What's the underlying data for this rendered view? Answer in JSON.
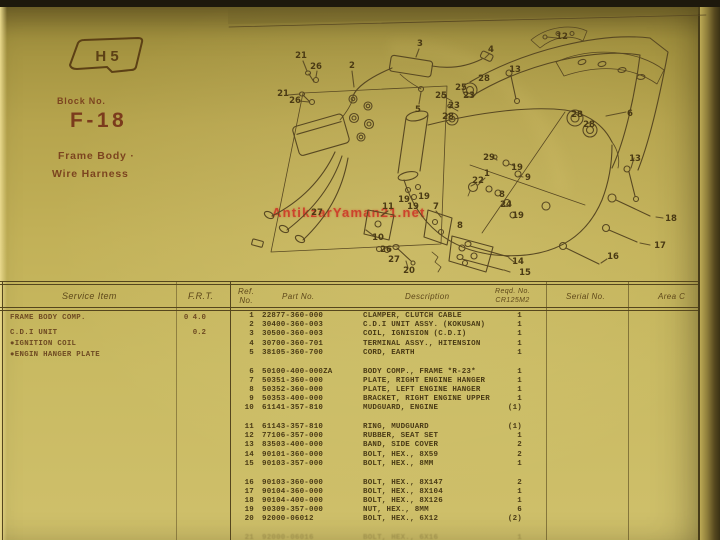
{
  "colors": {
    "page_bg": "#c2b158",
    "ink": "#493a15",
    "header_red": "#7b3b1c",
    "watermark_red": "#cd3425"
  },
  "header": {
    "badge": "H 5",
    "block_label": "Block No.",
    "block_no": "F-18",
    "subtitle1": "Frame Body ·",
    "subtitle2": "Wire Harness",
    "watermark": "AntikzarYaman21.net"
  },
  "service_table": {
    "headers": {
      "item": "Service Item",
      "frt": "F.R.T."
    },
    "rows": [
      {
        "item": "FRAME BODY COMP.",
        "frt": "0 4.0"
      },
      {
        "item": "C.D.I UNIT",
        "frt": "0.2"
      },
      {
        "item": "●IGNITION COIL",
        "frt": ""
      },
      {
        "item": "●ENGIN HANGER PLATE",
        "frt": ""
      }
    ]
  },
  "parts_table": {
    "headers": {
      "ref_line1": "Ref.",
      "ref_line2": "No.",
      "part": "Part No.",
      "desc": "Description",
      "reqd_line1": "Reqd. No.",
      "reqd_line2": "CR125M2",
      "serial": "Serial No.",
      "area": "Area C"
    },
    "rows": [
      {
        "ref": "1",
        "part": "22877-360-000",
        "desc": "CLAMPER, CLUTCH CABLE",
        "qty": "1"
      },
      {
        "ref": "2",
        "part": "30400-360-003",
        "desc": "C.D.I UNIT ASSY. (KOKUSAN)",
        "qty": "1"
      },
      {
        "ref": "3",
        "part": "30500-360-003",
        "desc": "COIL, IGNISION (C.D.I)",
        "qty": "1"
      },
      {
        "ref": "4",
        "part": "30700-360-701",
        "desc": "TERMINAL ASSY., HITENSION",
        "qty": "1"
      },
      {
        "ref": "5",
        "part": "38105-360-700",
        "desc": "CORD, EARTH",
        "qty": "1"
      },
      {
        "ref": "6",
        "part": "50100-400-000ZA",
        "desc": "BODY COMP., FRAME *R-23*",
        "qty": "1"
      },
      {
        "ref": "7",
        "part": "50351-360-000",
        "desc": "PLATE, RIGHT ENGINE HANGER",
        "qty": "1"
      },
      {
        "ref": "8",
        "part": "50352-360-000",
        "desc": "PLATE, LEFT ENGINE HANGER",
        "qty": "1"
      },
      {
        "ref": "9",
        "part": "50353-400-000",
        "desc": "BRACKET, RIGHT ENGINE UPPER",
        "qty": "1"
      },
      {
        "ref": "10",
        "part": "61141-357-810",
        "desc": "MUDGUARD, ENGINE",
        "qty": "(1)"
      },
      {
        "ref": "11",
        "part": "61143-357-810",
        "desc": "RING, MUDGUARD",
        "qty": "(1)"
      },
      {
        "ref": "12",
        "part": "77106-357-000",
        "desc": "RUBBER, SEAT SET",
        "qty": "1"
      },
      {
        "ref": "13",
        "part": "83503-400-000",
        "desc": "BAND, SIDE COVER",
        "qty": "2"
      },
      {
        "ref": "14",
        "part": "90101-360-000",
        "desc": "BOLT, HEX., 8X59",
        "qty": "2"
      },
      {
        "ref": "15",
        "part": "90103-357-000",
        "desc": "BOLT, HEX., 8MM",
        "qty": "1"
      },
      {
        "ref": "16",
        "part": "90103-360-000",
        "desc": "BOLT, HEX., 8X147",
        "qty": "2"
      },
      {
        "ref": "17",
        "part": "90104-360-000",
        "desc": "BOLT, HEX., 8X104",
        "qty": "1"
      },
      {
        "ref": "18",
        "part": "90104-400-000",
        "desc": "BOLT, HEX., 8X126",
        "qty": "1"
      },
      {
        "ref": "19",
        "part": "90309-357-000",
        "desc": "NUT, HEX., 8MM",
        "qty": "6"
      },
      {
        "ref": "20",
        "part": "92000-06012",
        "desc": "BOLT, HEX., 6X12",
        "qty": "(2)"
      },
      {
        "ref": "21",
        "part": "92000-06016",
        "desc": "BOLT, HEX., 6X16",
        "qty": "1",
        "faded": true
      }
    ]
  },
  "diagram": {
    "callouts": [
      {
        "n": "21",
        "x": 301,
        "y": 58
      },
      {
        "n": "26",
        "x": 316,
        "y": 69
      },
      {
        "n": "21",
        "x": 283,
        "y": 96
      },
      {
        "n": "26",
        "x": 295,
        "y": 103
      },
      {
        "n": "2",
        "x": 352,
        "y": 68
      },
      {
        "n": "3",
        "x": 420,
        "y": 46
      },
      {
        "n": "12",
        "x": 562,
        "y": 39
      },
      {
        "n": "4",
        "x": 491,
        "y": 52
      },
      {
        "n": "13",
        "x": 515,
        "y": 72
      },
      {
        "n": "28",
        "x": 484,
        "y": 81
      },
      {
        "n": "25",
        "x": 461,
        "y": 90
      },
      {
        "n": "25",
        "x": 441,
        "y": 98
      },
      {
        "n": "23",
        "x": 469,
        "y": 98
      },
      {
        "n": "23",
        "x": 454,
        "y": 108
      },
      {
        "n": "5",
        "x": 418,
        "y": 112
      },
      {
        "n": "28",
        "x": 448,
        "y": 119
      },
      {
        "n": "28",
        "x": 577,
        "y": 117
      },
      {
        "n": "28",
        "x": 589,
        "y": 127
      },
      {
        "n": "6",
        "x": 630,
        "y": 116
      },
      {
        "n": "13",
        "x": 635,
        "y": 161
      },
      {
        "n": "29",
        "x": 489,
        "y": 160
      },
      {
        "n": "19",
        "x": 517,
        "y": 170
      },
      {
        "n": "9",
        "x": 528,
        "y": 180
      },
      {
        "n": "1",
        "x": 487,
        "y": 176
      },
      {
        "n": "22",
        "x": 478,
        "y": 183
      },
      {
        "n": "8",
        "x": 502,
        "y": 197
      },
      {
        "n": "24",
        "x": 506,
        "y": 207
      },
      {
        "n": "19",
        "x": 518,
        "y": 218
      },
      {
        "n": "19",
        "x": 404,
        "y": 202
      },
      {
        "n": "19",
        "x": 424,
        "y": 199
      },
      {
        "n": "19",
        "x": 413,
        "y": 209
      },
      {
        "n": "11",
        "x": 388,
        "y": 209
      },
      {
        "n": "7",
        "x": 436,
        "y": 209
      },
      {
        "n": "8",
        "x": 460,
        "y": 228
      },
      {
        "n": "27",
        "x": 317,
        "y": 215
      },
      {
        "n": "10",
        "x": 378,
        "y": 240
      },
      {
        "n": "26",
        "x": 386,
        "y": 252
      },
      {
        "n": "27",
        "x": 394,
        "y": 262
      },
      {
        "n": "20",
        "x": 409,
        "y": 273
      },
      {
        "n": "14",
        "x": 518,
        "y": 264
      },
      {
        "n": "15",
        "x": 525,
        "y": 275
      },
      {
        "n": "18",
        "x": 671,
        "y": 221
      },
      {
        "n": "17",
        "x": 660,
        "y": 248
      },
      {
        "n": "16",
        "x": 613,
        "y": 259
      }
    ]
  }
}
